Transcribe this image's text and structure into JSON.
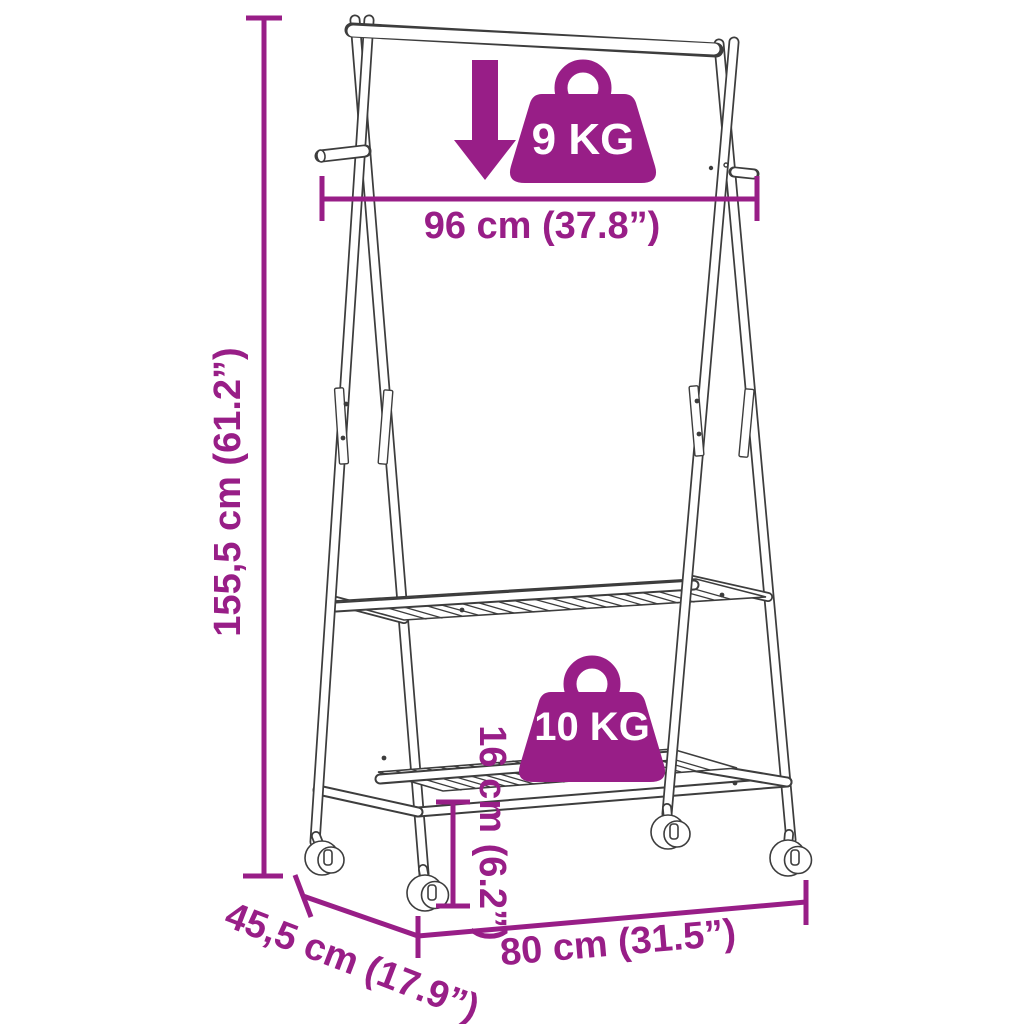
{
  "page": {
    "background": "#ffffff"
  },
  "colors": {
    "accent": "#981e87",
    "line_art": "#3d3d3d",
    "badge_text": "#ffffff"
  },
  "diagram": {
    "kind": "product-dimension-diagram",
    "product": "A-frame clothes rack with hanging rail, two slatted shelves and caster wheels",
    "dimensions": {
      "rail_width": "96 cm (37.8”)",
      "height": "155,5 cm (61.2”)",
      "ground_clearance": "16 cm (6.2”)",
      "depth": "45,5 cm (17.9”)",
      "base_width": "80 cm (31.5”)"
    },
    "capacities": {
      "hanging_rail": "9 KG",
      "shelf": "10 KG"
    },
    "icons": {
      "arrow": "down-arrow-icon",
      "weight": "weight-bag-icon",
      "wheel": "caster-wheel-icon"
    }
  }
}
